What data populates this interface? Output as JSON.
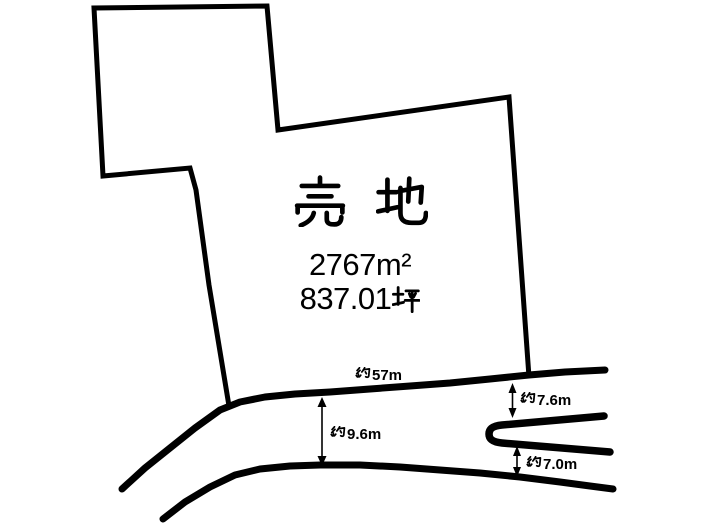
{
  "canvas": {
    "width": 705,
    "height": 525,
    "background": "#ffffff",
    "ink": "#000000"
  },
  "listing": {
    "title": "売 地",
    "title_chars": [
      "売",
      "地"
    ],
    "area_sqm": "2767m²",
    "area_tsubo": "837.01坪",
    "area_tsubo_value": "837.01",
    "area_tsubo_unit": "坪"
  },
  "measurements": {
    "frontage": {
      "label": "約57m",
      "prefix": "約",
      "value": "57m"
    },
    "front_road_width": {
      "label": "約9.6m",
      "prefix": "約",
      "value": "9.6m"
    },
    "side_road_upper_width": {
      "label": "約7.6m",
      "prefix": "約",
      "value": "7.6m"
    },
    "side_road_lower_width": {
      "label": "約7.0m",
      "prefix": "約",
      "value": "7.0m"
    }
  }
}
